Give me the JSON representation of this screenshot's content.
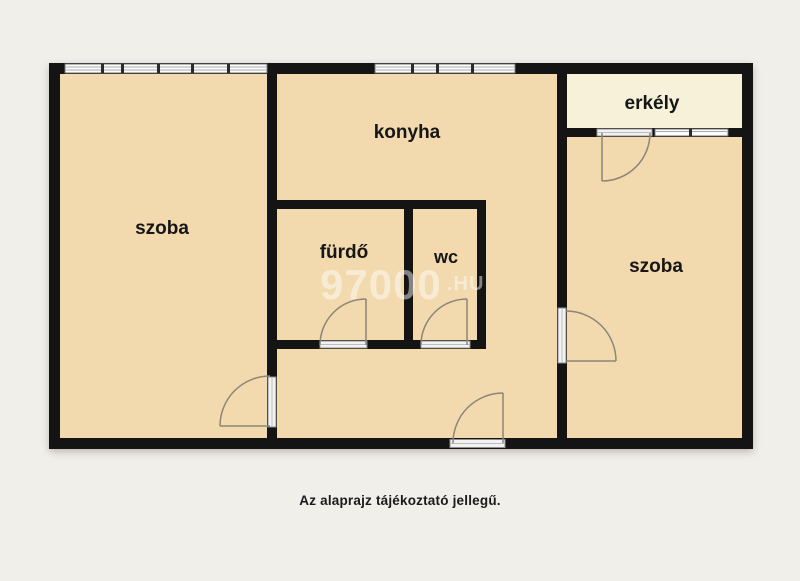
{
  "page": {
    "caption": "Az alaprajz tájékoztató jellegű.",
    "background_color": "#f1efea"
  },
  "watermark": {
    "text": "97000",
    "suffix": ".HU"
  },
  "plan": {
    "wall_color": "#141414",
    "floor_color": "#f2d9ae",
    "balcony_floor_color": "#f8f1da",
    "door_line_color": "#8b8678",
    "rooms": {
      "room_left": {
        "label": "szoba"
      },
      "kitchen": {
        "label": "konyha"
      },
      "bathroom": {
        "label": "fürdő"
      },
      "wc": {
        "label": "wc"
      },
      "balcony": {
        "label": "erkély"
      },
      "room_right": {
        "label": "szoba"
      }
    }
  }
}
